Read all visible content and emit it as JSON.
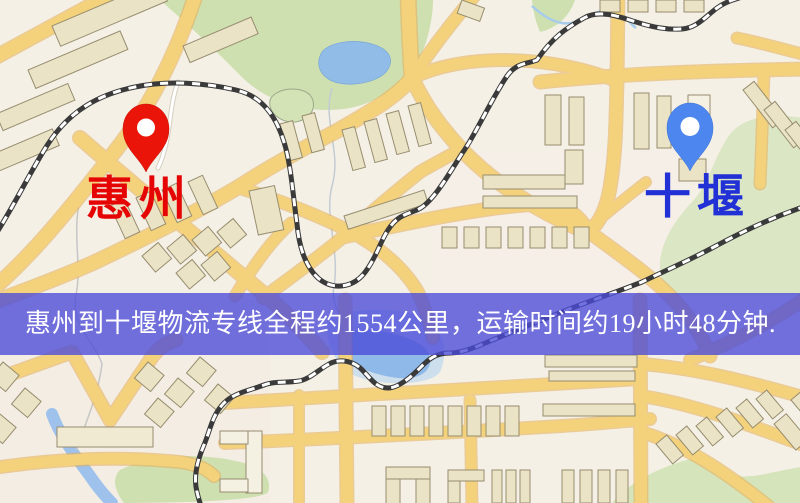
{
  "map": {
    "markers": [
      {
        "id": "origin",
        "label": "惠州",
        "pin_color": "#ea1408",
        "label_color": "#e60505"
      },
      {
        "id": "destination",
        "label": "十堰",
        "pin_color": "#4d86ef",
        "label_color": "#2231d6"
      }
    ],
    "banner": {
      "text": "惠州到十堰物流专线全程约1554公里，运输时间约19小时48分钟.",
      "background": "#4a4ad8",
      "opacity": 0.78,
      "text_color": "#ffffff"
    },
    "route": {
      "origin": "惠州",
      "destination": "十堰",
      "service": "物流专线",
      "distance_km": 1554,
      "duration": "19小时48分钟"
    },
    "palette": {
      "background": "#f4f0e6",
      "road_fill": "#f4d27c",
      "road_casing": "#e5ad54",
      "park": "#cfe0b0",
      "water": "#8fb9e8",
      "building": "#ebe3c6",
      "railway": "#3a3a3a"
    }
  }
}
